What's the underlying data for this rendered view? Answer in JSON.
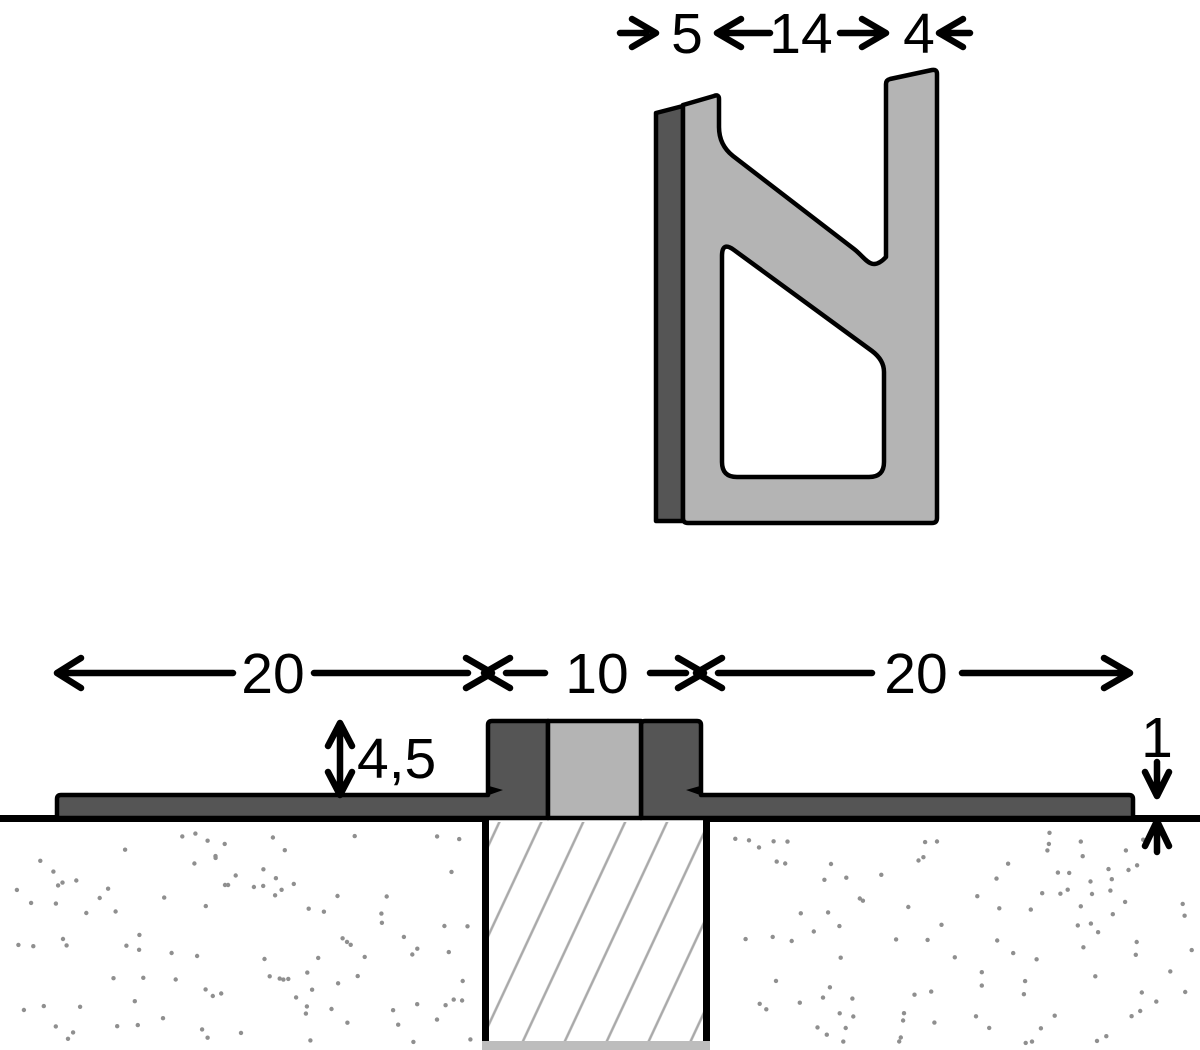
{
  "diagram": {
    "title": "movement-joint-profile-cross-section",
    "profile_view": {
      "description": "loose profile cross-section, dimension chain across top",
      "segment_widths": {
        "left": "5",
        "middle": "14",
        "right": "4"
      }
    },
    "installed_view": {
      "description": "profile installed over joint gap between two substrate slabs",
      "left_flange_width": "20",
      "joint_width": "10",
      "right_flange_width": "20",
      "visible_height": "4,5",
      "flange_thickness": "1"
    }
  },
  "colors": {
    "dark": "#555555",
    "light": "#b4b4b4",
    "hatch": "#a9a9a9",
    "dot": "#8f8f8f",
    "strip": "#bdbdbd",
    "outline": "#000000"
  }
}
